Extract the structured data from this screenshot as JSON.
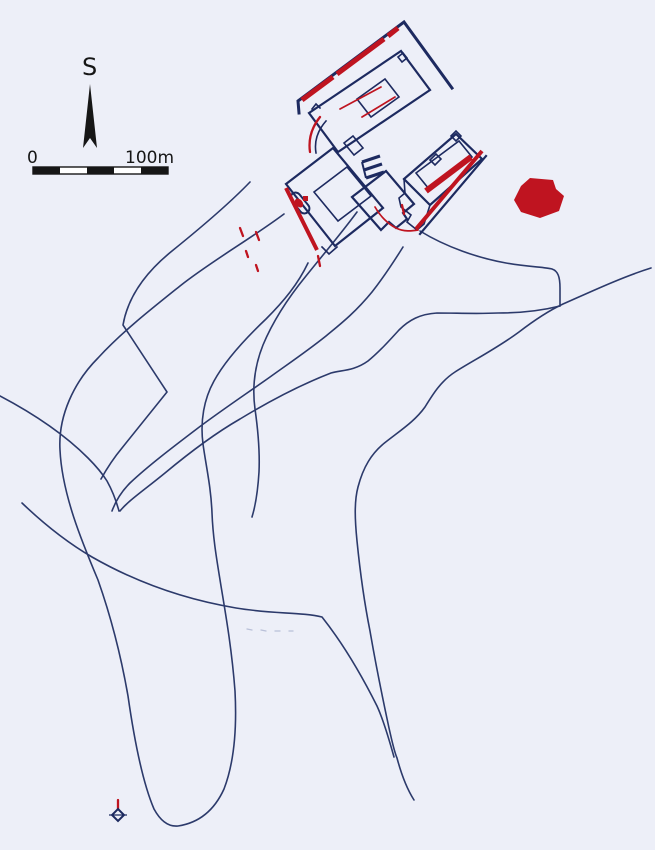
{
  "page": {
    "type": "scanned site plan",
    "background_color": "#edeff8"
  },
  "colors": {
    "bg": "#edeff8",
    "line": "#2c3a6b",
    "building": "#1d2a60",
    "red": "#bf1420",
    "black": "#161616",
    "faint": "#b9c0d8"
  },
  "compass": {
    "label": "S"
  },
  "scale_bar": {
    "start_label": "0",
    "end_label": "100m",
    "segments": 5
  },
  "features": {
    "building_complex": "farmstead building outlines",
    "red_accents": "red highlighted walls and stripes",
    "red_area": "solid red polygon",
    "field_lines": "field and enclosure boundary lines",
    "cross_symbol": "small cross marker"
  }
}
